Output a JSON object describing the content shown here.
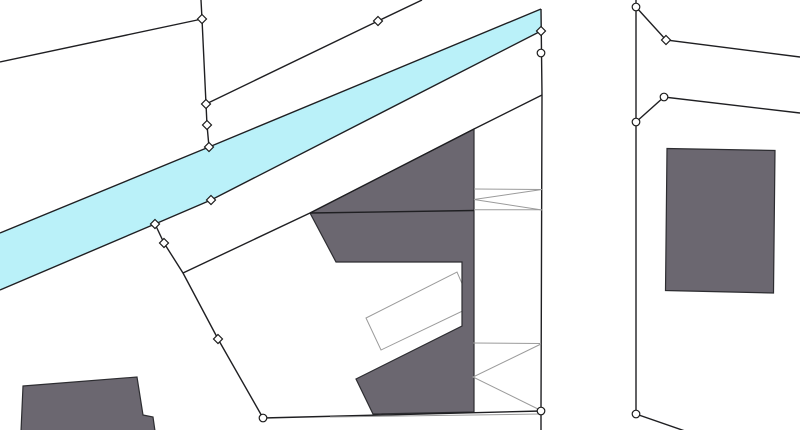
{
  "map": {
    "canvas": {
      "width": 800,
      "height": 430,
      "background": "#ffffff"
    },
    "colors": {
      "water_fill": "#baf1f9",
      "building_fill": "#6b6770",
      "building_stroke": "#2d2d31",
      "boundary_stroke": "#1f1f22",
      "annotation_stroke": "#9b9b9b",
      "marker_fill": "#ffffff",
      "marker_stroke": "#1a1a1a"
    },
    "water": {
      "name": "water-band",
      "points": "0,233 209,147 541,9 541,31 211,200 155,224 0,290"
    },
    "underlay_annotations": [
      {
        "name": "annex-outline",
        "type": "polygon",
        "points": "366,318 381,350 472,306.5 457,272"
      }
    ],
    "buildings": [
      {
        "name": "building-central",
        "points": "310,213 474,129 474,412 373,414 356,379 462,326 462,262 336,262"
      },
      {
        "name": "building-right",
        "points": "667,148.5 775,150.5 773.5,293 665.5,290.5"
      },
      {
        "name": "building-bottom-left",
        "points": "23,386 137,377 143,415 153,417 155,431 21,431"
      }
    ],
    "boundaries": [
      {
        "name": "parcel-line-upper-left",
        "points": "0,62 202,19"
      },
      {
        "name": "parcel-line-top-chain",
        "points": "201,0 202,19 206,104 207,125 209,147"
      },
      {
        "name": "parcel-line-top-diagonal",
        "points": "206,104 378,21 422,0"
      },
      {
        "name": "water-edge-upper",
        "points": "0,233 209,147 541,9"
      },
      {
        "name": "water-edge-lower",
        "points": "0,290 155,224 211,200 541,31"
      },
      {
        "name": "parcel-line-vertical-main",
        "points": "541,9 542,95 541,411 541,431"
      },
      {
        "name": "parcel-line-building-slant",
        "points": "542,95 474,129 310,213"
      },
      {
        "name": "parcel-line-building-cross",
        "points": "310,213 474,210.5"
      },
      {
        "name": "parcel-line-left-chain",
        "points": "155,224 164,243 183,273 218,339 263,418"
      },
      {
        "name": "parcel-line-mid-diagonal",
        "points": "183,273 310,213"
      },
      {
        "name": "parcel-line-bottom",
        "points": "263,418 541,411"
      },
      {
        "name": "parcel-line-vertical-right",
        "points": "636,0 636,414 685,431"
      },
      {
        "name": "parcel-line-right-upper",
        "points": "636,7 666,40 800,57"
      },
      {
        "name": "parcel-line-right-lower",
        "points": "636,122 664,97 800,113"
      }
    ],
    "annotations": [
      {
        "name": "overhang-mark-upper-top",
        "points": "474,189 542,189.5"
      },
      {
        "name": "overhang-mark-upper-bottom",
        "points": "474,209.7 542,209.7"
      },
      {
        "name": "overhang-mark-upper-chevron",
        "points": "542,189.5 474,199.5 542,210"
      },
      {
        "name": "overhang-mark-lower-top",
        "points": "473,343 541,343.5"
      },
      {
        "name": "overhang-mark-lower-chevron",
        "points": "541,344 473,377 541,410.5"
      },
      {
        "name": "overhang-mark-bottom-edge",
        "points": "330,417 540,414"
      }
    ],
    "markers": {
      "diamonds": [
        [
          202,
          19
        ],
        [
          206,
          104
        ],
        [
          207,
          125
        ],
        [
          209,
          147
        ],
        [
          378,
          21
        ],
        [
          155,
          224
        ],
        [
          211,
          200
        ],
        [
          541,
          31
        ],
        [
          164,
          243
        ],
        [
          218,
          339
        ],
        [
          666,
          40
        ]
      ],
      "circles": [
        [
          541,
          53
        ],
        [
          636,
          7
        ],
        [
          664,
          97
        ],
        [
          636,
          122
        ],
        [
          263,
          418
        ],
        [
          541,
          411
        ],
        [
          636,
          414
        ]
      ]
    }
  }
}
